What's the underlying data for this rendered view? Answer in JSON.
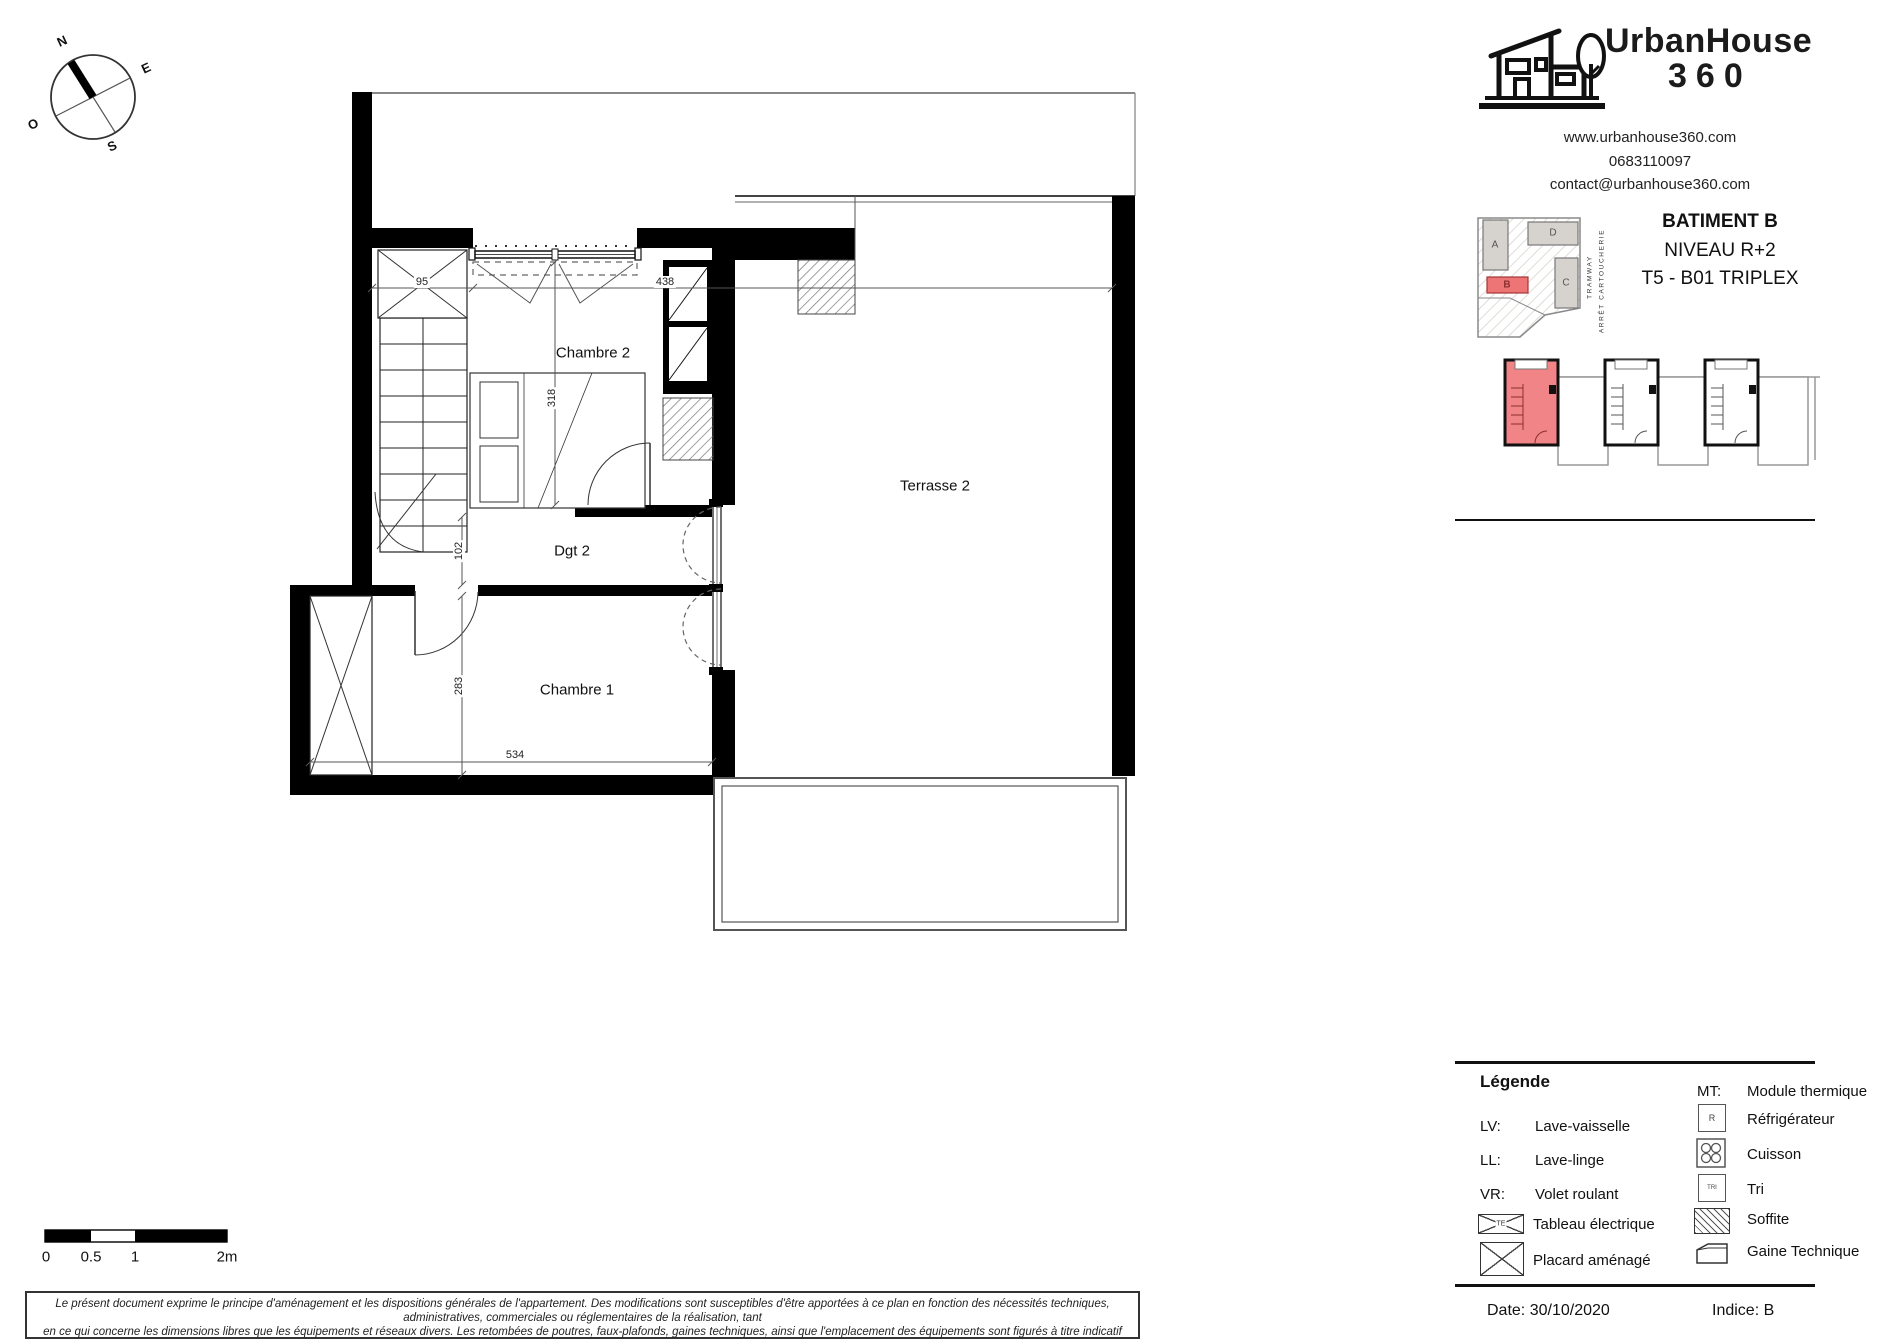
{
  "brand": {
    "name_top": "UrbanHouse",
    "name_bottom": "360",
    "website": "www.urbanhouse360.com",
    "phone": "0683110097",
    "email": "contact@urbanhouse360.com"
  },
  "title_block": {
    "building": "BATIMENT B",
    "level": "NIVEAU R+2",
    "unit": "T5 - B01 TRIPLEX"
  },
  "site_plan": {
    "blocks": [
      {
        "label": "A"
      },
      {
        "label": "B"
      },
      {
        "label": "C"
      },
      {
        "label": "D"
      }
    ],
    "highlighted_block": "B",
    "tramway": "TRAMWAY",
    "tram_stop": "ARRÊT CARTOUCHERIE"
  },
  "compass": {
    "north": "N",
    "east": "E",
    "south": "S",
    "west": "O"
  },
  "plan": {
    "rooms": {
      "chambre2": "Chambre 2",
      "dgt2": "Dgt 2",
      "chambre1": "Chambre 1",
      "terrasse2": "Terrasse 2"
    },
    "dims": {
      "d95": "95",
      "d438": "438",
      "d318": "318",
      "d102": "102",
      "d283": "283",
      "d534": "534"
    }
  },
  "legend": {
    "title": "Légende",
    "left": [
      {
        "abbr": "LV:",
        "label": "Lave-vaisselle"
      },
      {
        "abbr": "LL:",
        "label": "Lave-linge"
      },
      {
        "abbr": "VR:",
        "label": "Volet roulant"
      },
      {
        "icon_text": "TE",
        "label": "Tableau électrique"
      },
      {
        "label": "Placard aménagé"
      }
    ],
    "right": [
      {
        "abbr": "MT:",
        "label": "Module thermique"
      },
      {
        "icon_text": "R",
        "label": "Réfrigérateur"
      },
      {
        "label": "Cuisson"
      },
      {
        "icon_text": "TRI",
        "label": "Tri"
      },
      {
        "label": "Soffite"
      },
      {
        "label": "Gaine Technique"
      }
    ]
  },
  "scale_bar": {
    "t0": "0",
    "t05": "0.5",
    "t1": "1",
    "t2": "2m"
  },
  "footer": {
    "date_label": "Date:",
    "date_value": "30/10/2020",
    "indice_label": "Indice:",
    "indice_value": "B"
  },
  "disclaimer": {
    "line1": "Le présent document exprime le principe d'aménagement et les dispositions générales de l'appartement. Des modifications sont susceptibles d'être apportées à ce plan en fonction des nécessités techniques, administratives, commerciales ou réglementaires de la réalisation, tant",
    "line2": "en ce qui concerne les dimensions libres que les équipements et réseaux divers. Les retombées de poutres, faux-plafonds, gaines techniques, ainsi que l'emplacement des équipements sont figurés à titre indicatif"
  },
  "colors": {
    "highlight_red": "#f08486",
    "block_grey": "#d6d2ce",
    "wall_black": "#000000"
  }
}
